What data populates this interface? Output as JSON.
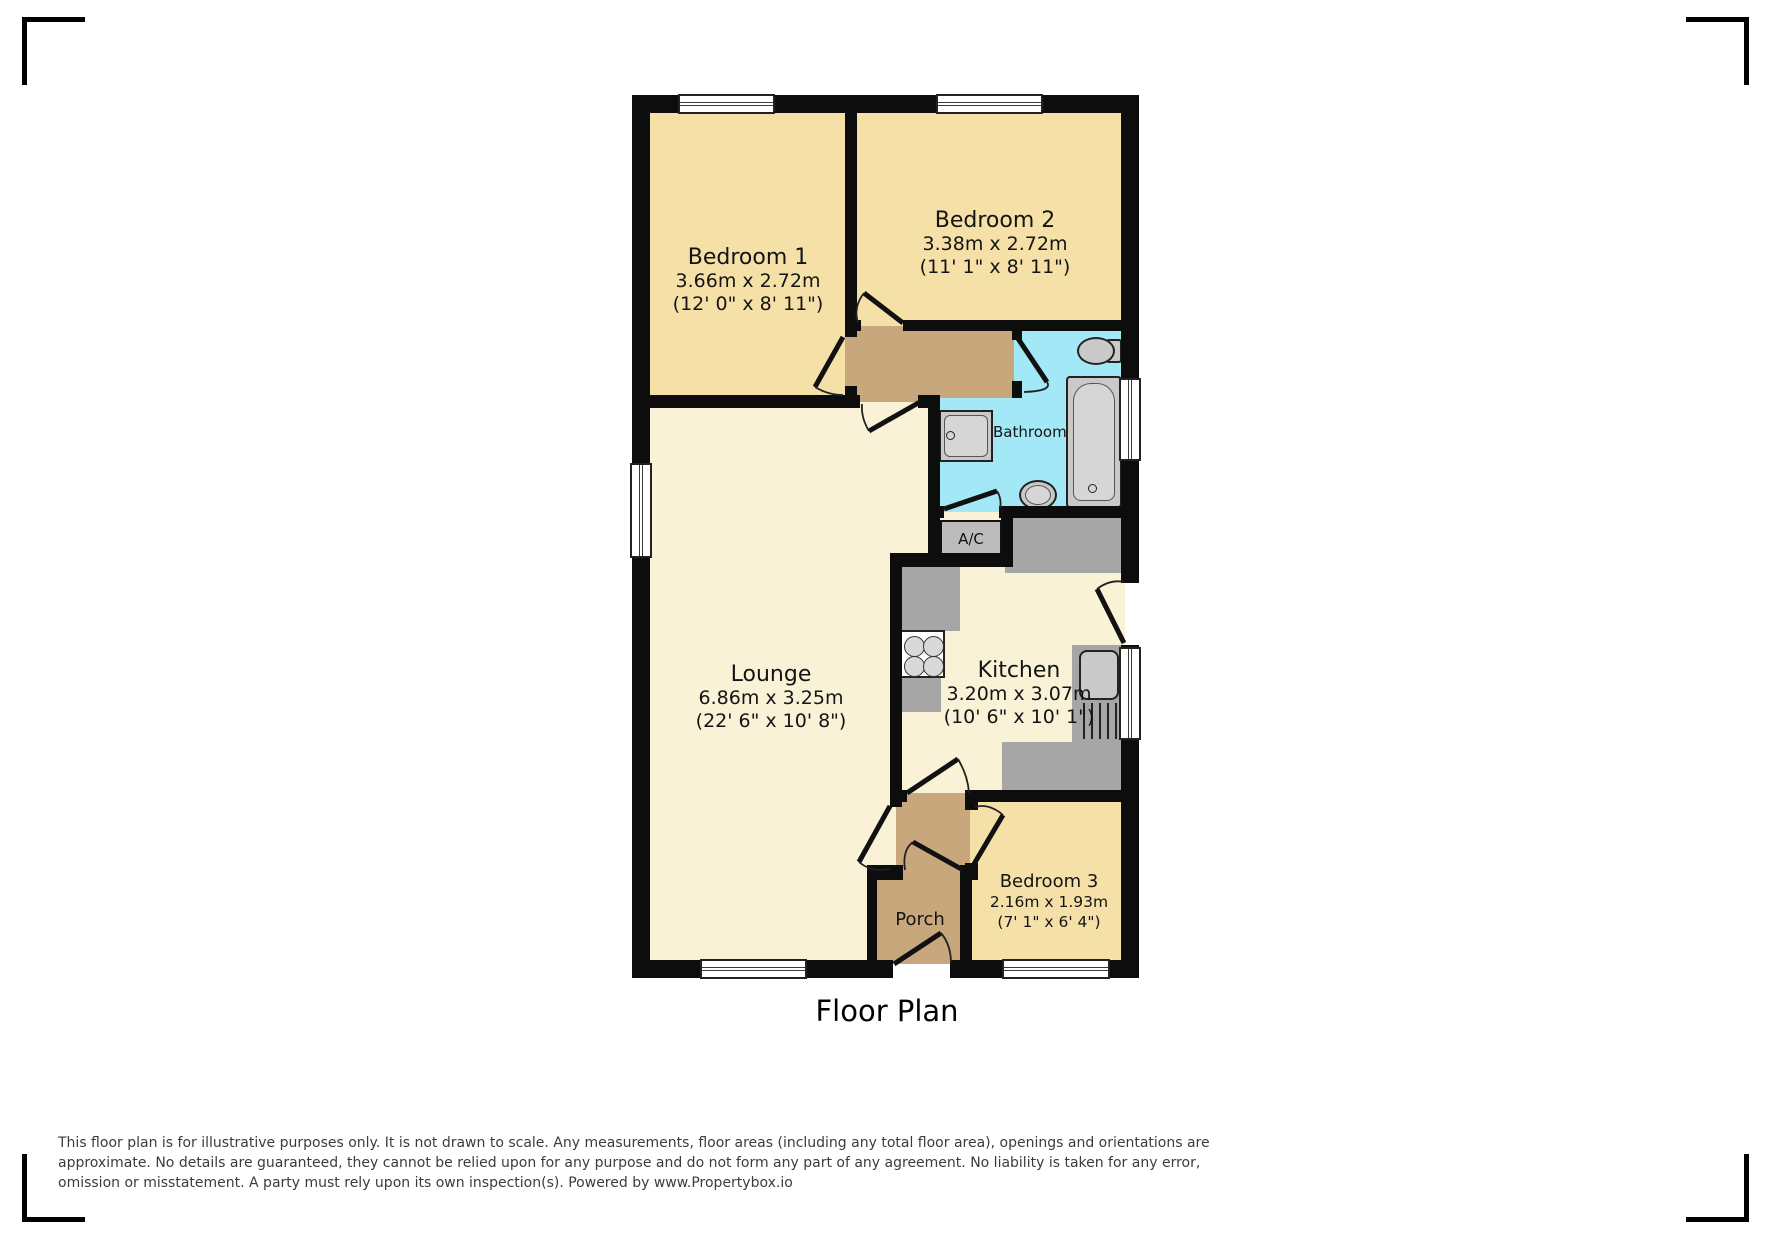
{
  "title": "Floor Plan",
  "rooms": [
    {
      "label": "Bedroom 1",
      "metric": "3.66m x 2.72m",
      "imperial": "(12' 0\" x 8' 11\")"
    },
    {
      "label": "Bedroom 2",
      "metric": "3.38m x 2.72m",
      "imperial": "(11' 1\" x 8' 11\")"
    },
    {
      "label": "Lounge",
      "metric": "6.86m x 3.25m",
      "imperial": "(22' 6\" x 10' 8\")"
    },
    {
      "label": "Kitchen",
      "metric": "3.20m x 3.07m",
      "imperial": "(10' 6\" x 10' 1\")"
    },
    {
      "label": "Bedroom 3",
      "metric": "2.16m x 1.93m",
      "imperial": "(7' 1\" x 6' 4\")"
    }
  ],
  "labels": {
    "bathroom": "Bathroom",
    "airing_cupboard": "A/C",
    "porch": "Porch"
  },
  "disclaimer": {
    "lines": [
      "This floor plan is for illustrative purposes only. It is not drawn to scale. Any measurements, floor areas (including any total floor area), openings and orientations are",
      "approximate. No details are guaranteed, they cannot be relied upon for any purpose and do not form any part of any agreement. No liability is taken for any error,",
      "omission or misstatement. A party must rely upon its own inspection(s). Powered by www.Propertybox.io"
    ]
  },
  "colors": {
    "wall": "#0d0d0d",
    "bedroom": "#f5e1a8",
    "living": "#f9f2d7",
    "hall": "#c7a77b",
    "bathroom": "#a3e8f6",
    "counter": "#a6a6a6",
    "cupboard": "#bcbcbc",
    "fixture": "#c9c9c9",
    "fixture_inner": "#d6d6d6",
    "disclaimer_text": "#3c3c3c"
  }
}
